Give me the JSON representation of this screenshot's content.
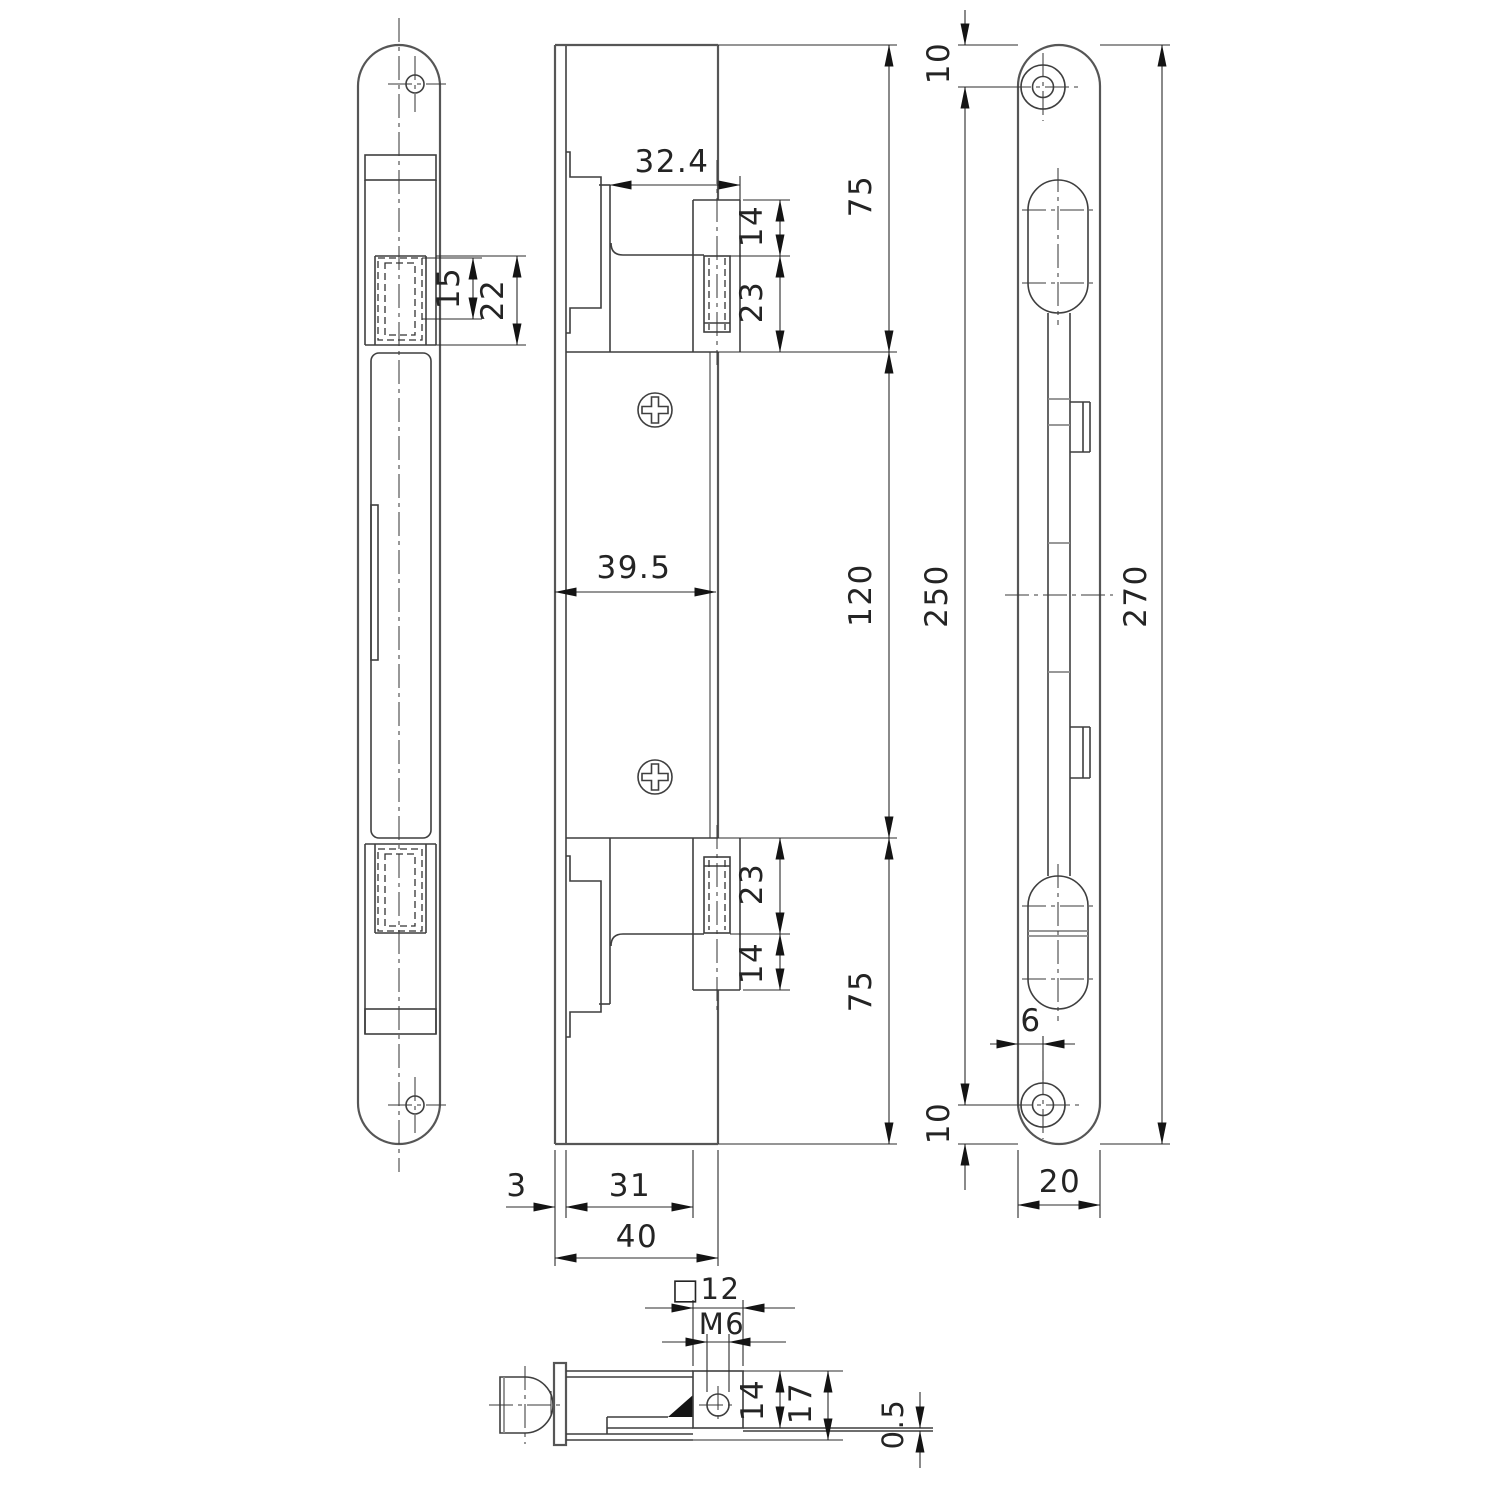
{
  "drawing": {
    "background": "#ffffff",
    "outline_color": "#565656",
    "dimension_color": "#242424",
    "views": {
      "front": {
        "label": "front-view",
        "dims": {
          "d15": "15",
          "d22": "22"
        }
      },
      "side": {
        "label": "side-view",
        "dims": {
          "d32_4": "32.4",
          "d14_top": "14",
          "d23_top": "23",
          "d75_top": "75",
          "d120": "120",
          "d39_5": "39.5",
          "d23_bottom": "23",
          "d14_bottom": "14",
          "d75_bottom": "75",
          "d3": "3",
          "d31": "31",
          "d40": "40"
        }
      },
      "plate": {
        "label": "strike-plate-view",
        "dims": {
          "d10_top": "10",
          "d250": "250",
          "d270": "270",
          "d6": "6",
          "d10_bottom": "10",
          "d20": "20"
        }
      },
      "section": {
        "label": "section-view",
        "dims": {
          "d_sq12": "□12",
          "d_m6": "M6",
          "d14": "14",
          "d17": "17",
          "d0_5": "0.5"
        }
      }
    }
  }
}
